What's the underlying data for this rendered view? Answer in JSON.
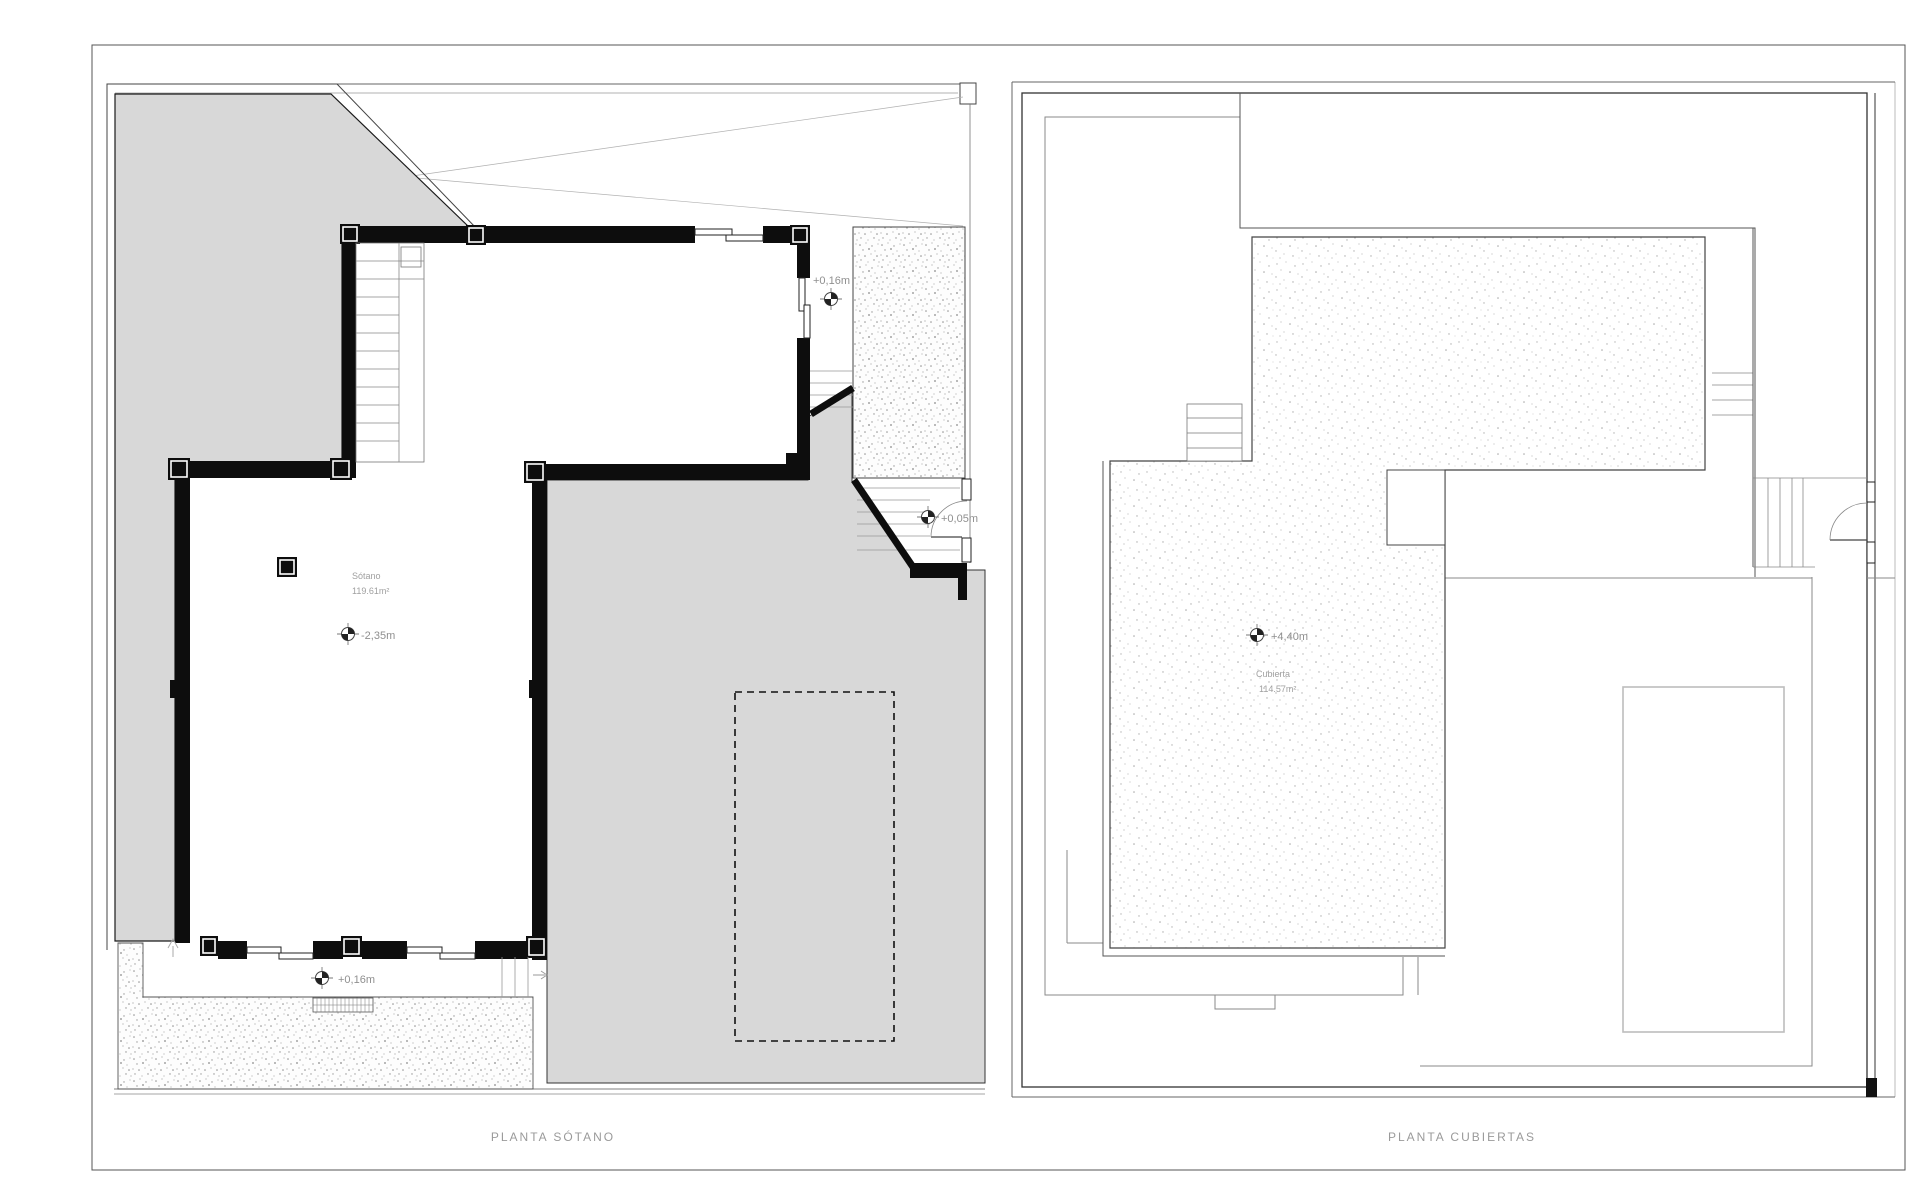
{
  "sheet": {
    "left_plan": {
      "caption": "PLANTA SÓTANO",
      "room_label": "Sótano",
      "room_area": "119.61m²",
      "levels": {
        "basement": "-2,35m",
        "terrace_right": "+0,16m",
        "door_right": "+0,05m",
        "terrace_bottom": "+0,16m"
      }
    },
    "right_plan": {
      "caption": "PLANTA CUBIERTAS",
      "roof_label": "Cubierta",
      "roof_area": "114.57m²",
      "levels": {
        "roof": "+4,40m"
      }
    },
    "colors": {
      "fill_gray": "#d8d8d8",
      "wall_black": "#0d0d0d",
      "line_dark": "#444444",
      "line_light": "#8a8a8a",
      "text_gray": "#9a9a9a"
    }
  }
}
